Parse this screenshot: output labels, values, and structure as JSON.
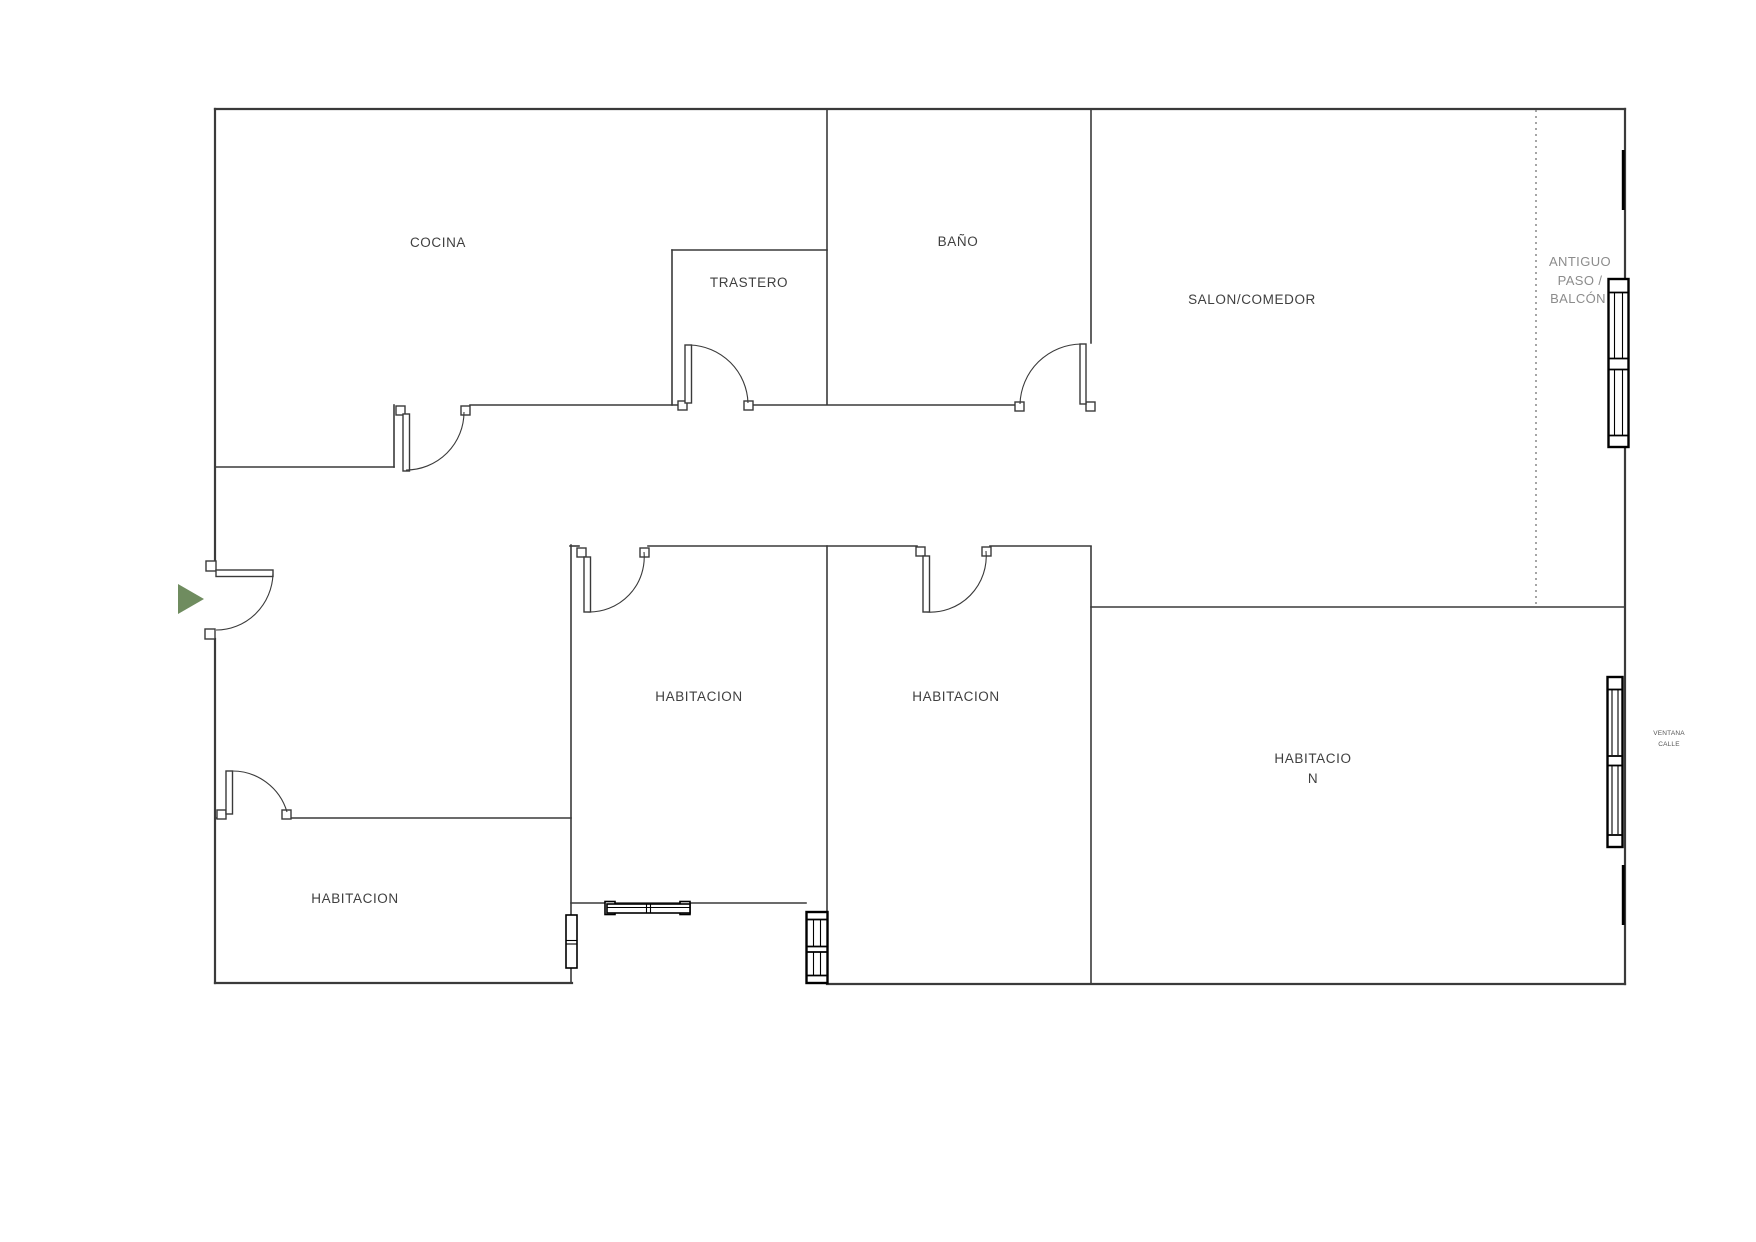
{
  "rooms": [
    {
      "name": "cocina",
      "label": "COCINA"
    },
    {
      "name": "trastero",
      "label": "TRASTERO"
    },
    {
      "name": "bano",
      "label": "BAÑO"
    },
    {
      "name": "salon-comedor",
      "label": "SALON/COMEDOR"
    },
    {
      "name": "habitacion-top-left",
      "label": "HABITACION"
    },
    {
      "name": "habitacion-top-right",
      "label": "HABITACION"
    },
    {
      "name": "habitacion-right-line1",
      "label": "HABITACIO"
    },
    {
      "name": "habitacion-right-line2",
      "label": "N"
    },
    {
      "name": "habitacion-bottom-left",
      "label": "HABITACION"
    }
  ],
  "annotations": {
    "antiguo_paso": {
      "lines": [
        "ANTIGUO",
        "PASO /",
        "BALCÓN"
      ]
    },
    "ventana_calle": {
      "lines": [
        "VENTANA",
        "CALLE"
      ]
    }
  },
  "colors": {
    "background": "#ffffff",
    "wall": "#3a3a3a",
    "window_frame": "#000000",
    "dashed_line": "#8f8f8f",
    "room_label": "#3f3f3f",
    "muted_label": "#8c8c8c",
    "tiny_label": "#555555",
    "entry_arrow": "#6f8c5f"
  }
}
